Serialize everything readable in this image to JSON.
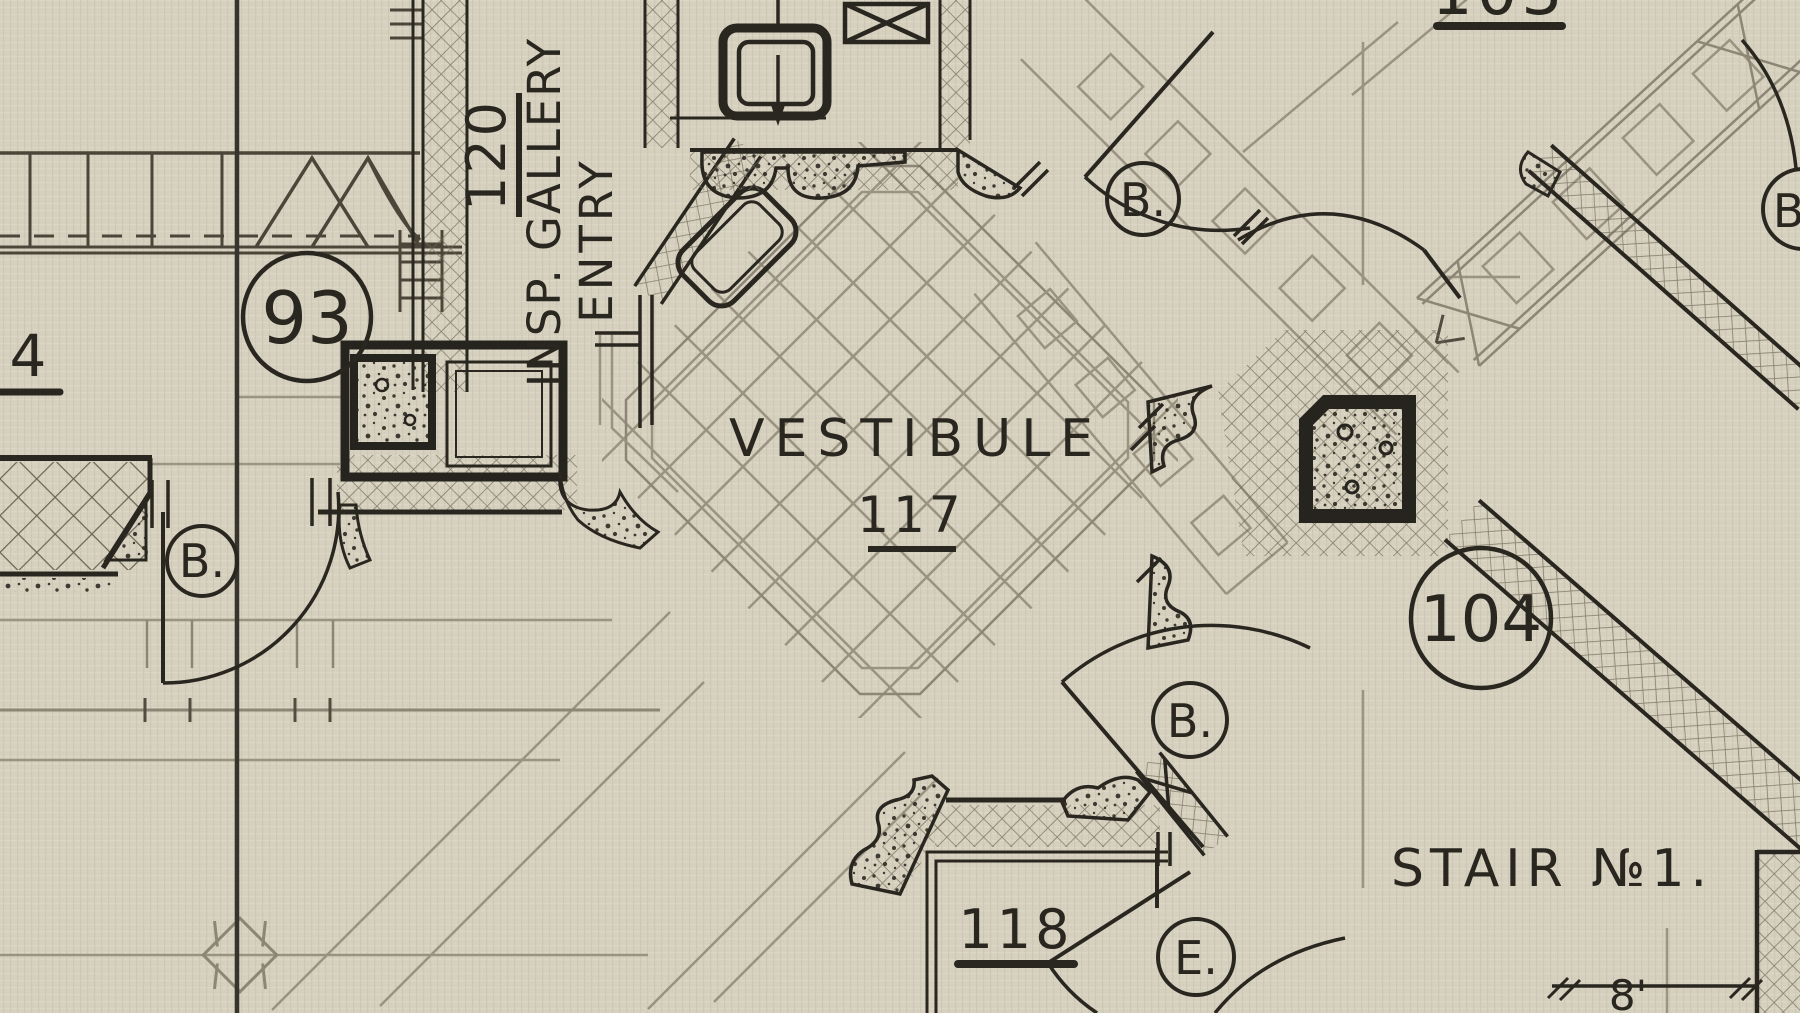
{
  "plan": {
    "title_note": "hand-drawn architectural floor plan, first floor vestibule area",
    "rooms": [
      {
        "id": "vestibule",
        "name": "VESTIBULE",
        "number": "117"
      },
      {
        "id": "insp-gallery-entry",
        "number": "120",
        "name_line1": "INSP. GALLERY",
        "name_line2": "ENTRY"
      },
      {
        "id": "room-118",
        "number": "118"
      },
      {
        "id": "stair-no-1",
        "name": "STAIR №1."
      },
      {
        "id": "room-103-partial",
        "number": "103"
      },
      {
        "id": "room-93",
        "number": "93"
      },
      {
        "id": "room-104",
        "number": "104"
      },
      {
        "id": "room-4-partial",
        "number": "4"
      }
    ],
    "door_labels": [
      {
        "text": "B."
      },
      {
        "text": "B."
      },
      {
        "text": "B."
      },
      {
        "text": "B."
      },
      {
        "text": "E."
      }
    ],
    "dimension_label": "8'"
  },
  "colors": {
    "paper": "#d9d3c2",
    "ink": "#26241d",
    "ink_medium": "#4a4438",
    "pencil": "#98917e"
  }
}
